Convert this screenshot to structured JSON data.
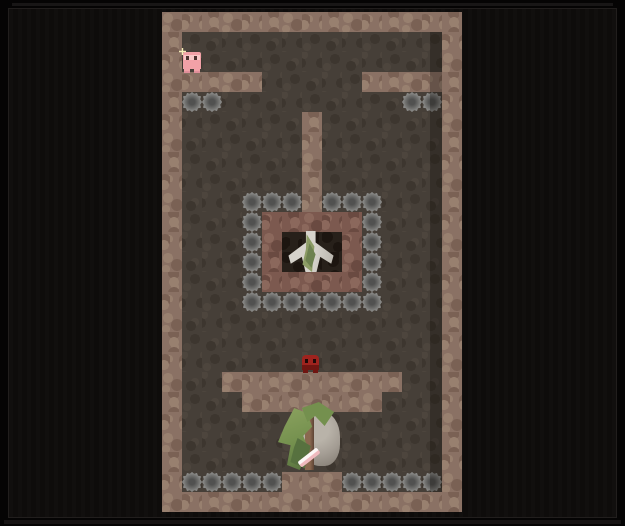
{
  "viewport": {
    "width": 625,
    "height": 526
  },
  "palette": {
    "frame": "#050404",
    "panel": "#0e0c0b",
    "panel_line": "#211e1d",
    "top_glow": "#1d1b1b",
    "bottom_strip": "#171414",
    "wall": "#8a7164",
    "wall_light": "#98806f",
    "wall_dark": "#7a6154",
    "brick": "#7c594f",
    "brick_light": "#8b685c",
    "brick_dark": "#6a4a41",
    "floor": "#463f38",
    "floor_light": "#4d453d",
    "floor_dark": "#3d362f",
    "alcove": "#27201a",
    "alcove_dark": "#1c1510",
    "boulder_light": "#a6a6a4",
    "boulder_mid": "#90908e",
    "boulder_dark": "#515150"
  },
  "map": {
    "x": 162,
    "y": 12,
    "tile": 20,
    "cols": 15,
    "rows": 25,
    "legend": {
      "W": "wall",
      "R": "brick-structure-wall",
      "A": "alcove-interior",
      "B": "boulder",
      ".": "floor"
    },
    "grid": [
      "WWWWWWWWWWWWWWW",
      "W.............W",
      "W.............W",
      "WWWWW.....WWWWW",
      "WBB.........BBW",
      "W......W......W",
      "W......W......W",
      "W......W......W",
      "W......W......W",
      "W...BBBWBBB...W",
      "W...BRRRRRB...W",
      "W...BRAAARB...W",
      "W...BRAAARB...W",
      "W...BRRRRRB...W",
      "W...BBBBBBB...W",
      "W.............W",
      "W.............W",
      "W.............W",
      "W..WWWWWWWWW..W",
      "W...WWWWWWW...W",
      "W.............W",
      "W.............W",
      "W.............W",
      "WBBBBBWWWBBBBBW",
      "WWWWWWWWWWWWWWW"
    ]
  },
  "entities": {
    "pig": {
      "label": "pink pig creature",
      "x": 183,
      "y": 52,
      "width": 18,
      "height": 21,
      "body": "#f2a1a7",
      "face": "#f8c9c8",
      "eye": "#4e3331",
      "legs": "#e08f9a",
      "sparkle": "#f6efb9"
    },
    "imp": {
      "label": "red imp creature",
      "x": 302,
      "y": 355,
      "width": 17,
      "height": 18,
      "head": "#9e231e",
      "jaw": "#701511",
      "eye": "#1e0908"
    },
    "statue": {
      "label": "mossy winged statue in alcove",
      "x": 288,
      "y": 231,
      "width": 46,
      "height": 41,
      "marble": "#d6d3cc",
      "marble_shadow": "#b7b3ab",
      "moss": "#8c9c66",
      "moss_dark": "#6d8150"
    },
    "bush": {
      "label": "bush with rock and sword",
      "x": 280,
      "y": 404,
      "width": 62,
      "height": 68,
      "rock": "#a49d94",
      "rock_light": "#b9b3a9",
      "rock_dark": "#847d74",
      "leaf": "#74904e",
      "leaf_light": "#8ba25f",
      "leaf_dark": "#57713f",
      "trunk": "#8a6850",
      "trunk_dark": "#5d4334",
      "sword_blade": "#f0b9be",
      "sword_light": "#fdf7f6"
    },
    "right_wall_shadow": {
      "label": "shadow along right wall",
      "x": 430,
      "y": 32,
      "width": 12,
      "height": 460,
      "shadow": "rgba(10,7,5,0.28)"
    }
  }
}
